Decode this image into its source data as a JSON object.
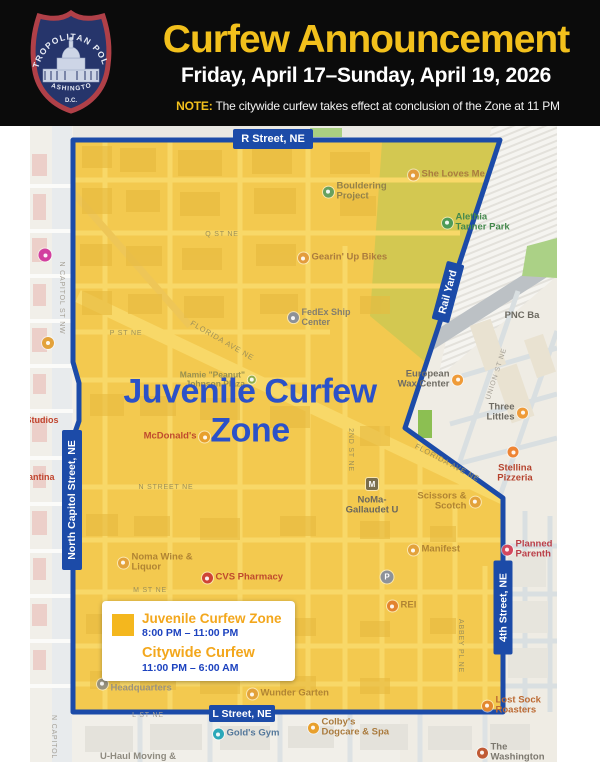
{
  "header": {
    "title": "Curfew Announcement",
    "date_range": "Friday, April 17–Sunday, April 19, 2026",
    "note_label": "NOTE:",
    "note_text": "The citywide curfew takes effect at conclusion of the Zone at 11 PM",
    "badge": {
      "top": "METROPOLITAN POLICE",
      "middle": "WASHINGTON",
      "bottom": "D.C."
    }
  },
  "map": {
    "zone_title": "Juvenile Curfew\nZone",
    "signs": [
      "R Street, NE",
      "North Capitol Street, NE",
      "Rail Yard",
      "4th Street, NE",
      "L Street, NE"
    ],
    "pois": [
      {
        "name": "q-st",
        "x": 222,
        "y": 235,
        "label": "Q ST NE",
        "color": "#9c8f58",
        "size": 7,
        "ls": 0.8,
        "align": "center"
      },
      {
        "name": "p-st",
        "x": 126,
        "y": 334,
        "label": "P ST NE",
        "color": "#9c8f58",
        "size": 7,
        "ls": 0.8,
        "align": "center"
      },
      {
        "name": "florida-ave-w",
        "x": 222,
        "y": 341,
        "label": "FLORIDA AVE NE",
        "color": "#9c8f58",
        "size": 7.5,
        "ls": 0.8,
        "align": "center",
        "rotate": 30
      },
      {
        "name": "n-street",
        "x": 166,
        "y": 488,
        "label": "N STREET NE",
        "color": "#9c8f58",
        "size": 7,
        "ls": 0.8,
        "align": "center"
      },
      {
        "name": "2nd-st",
        "x": 350,
        "y": 450,
        "label": "2ND ST NE",
        "color": "#9c8f58",
        "size": 7,
        "ls": 0.8,
        "align": "center",
        "rotate": 90
      },
      {
        "name": "m-st",
        "x": 150,
        "y": 591,
        "label": "M ST NE",
        "color": "#9c8f58",
        "size": 7,
        "ls": 0.8,
        "align": "center"
      },
      {
        "name": "union-st",
        "x": 497,
        "y": 374,
        "label": "UNION ST NE",
        "color": "#a5a096",
        "size": 7,
        "ls": 0.8,
        "align": "center",
        "rotate": -72
      },
      {
        "name": "abbey-pl",
        "x": 460,
        "y": 646,
        "label": "ABBEY PL NE",
        "color": "#9c8f58",
        "size": 7,
        "ls": 0.8,
        "align": "center",
        "rotate": 90
      },
      {
        "name": "n-capitol-st-nw",
        "x": 61,
        "y": 298,
        "label": "N CAPITOL ST NW",
        "color": "#a5a096",
        "size": 7,
        "ls": 0.8,
        "align": "center",
        "rotate": 90
      },
      {
        "name": "n-capitol",
        "x": 53,
        "y": 737,
        "label": "N CAPITOL",
        "color": "#a5a096",
        "size": 7,
        "ls": 0.8,
        "align": "center",
        "rotate": 90
      },
      {
        "name": "florida-ave-e",
        "x": 447,
        "y": 463,
        "label": "FLORIDA AVE NE",
        "color": "#9c8f58",
        "size": 7.5,
        "ls": 0.8,
        "align": "center",
        "rotate": 28
      },
      {
        "name": "l-st",
        "x": 148,
        "y": 716,
        "label": "L ST NE",
        "color": "#a5a096",
        "size": 7,
        "ls": 0.8,
        "align": "center"
      },
      {
        "name": "she-loves-me",
        "x": 413,
        "y": 175,
        "label": "She Loves Me",
        "color": "#aa7b3e",
        "size": 9.5,
        "bold": true,
        "icon": "#e39c3d",
        "align": "left"
      },
      {
        "name": "bouldering-project",
        "x": 328,
        "y": 192,
        "label": "Bouldering\nProject",
        "color": "#93824a",
        "size": 9.5,
        "bold": true,
        "icon": "#67a15e",
        "align": "left"
      },
      {
        "name": "alethia-tanner-park",
        "x": 447,
        "y": 223,
        "label": "Alethia\nTanner Park",
        "color": "#45894d",
        "size": 9.5,
        "bold": true,
        "icon": "#4d9b57",
        "align": "left"
      },
      {
        "name": "gearin-up-bikes",
        "x": 303,
        "y": 258,
        "label": "Gearin' Up Bikes",
        "color": "#aa7b3e",
        "size": 9.5,
        "bold": true,
        "icon": "#e39c3d",
        "align": "left"
      },
      {
        "name": "fedex-ship-center",
        "x": 293,
        "y": 318,
        "label": "FedEx Ship\nCenter",
        "color": "#837e6e",
        "size": 9,
        "bold": true,
        "icon": "#8d9197",
        "align": "left"
      },
      {
        "name": "mamie-johnson-plaza",
        "x": 252,
        "y": 380,
        "label": "Mamie \"Peanut\"\nJohnson Plaza",
        "color": "#98904f",
        "size": 8.5,
        "bold": true,
        "icon": "#8fae4a",
        "iconSize": 8,
        "align": "right"
      },
      {
        "name": "european-wax-center",
        "x": 458,
        "y": 380,
        "label": "European\nWax Center",
        "color": "#6f6c64",
        "size": 9.5,
        "bold": true,
        "icon": "#ef9b38",
        "align": "right"
      },
      {
        "name": "pnc-bank",
        "x": 522,
        "y": 316,
        "label": "PNC Ba",
        "color": "#6c6960",
        "size": 9.5,
        "bold": true,
        "align": "left"
      },
      {
        "name": "three-littles",
        "x": 523,
        "y": 413,
        "label": "Three Littles",
        "color": "#6f6c64",
        "size": 9.5,
        "bold": true,
        "icon": "#ef9b38",
        "align": "right"
      },
      {
        "name": "stellina-icon",
        "x": 513,
        "y": 452,
        "icon": "#ee8434",
        "align": "center"
      },
      {
        "name": "stellina-pizzeria",
        "x": 515,
        "y": 474,
        "label": "Stellina\nPizzeria",
        "color": "#b5432e",
        "size": 9.5,
        "bold": true,
        "align": "center"
      },
      {
        "name": "mcdonalds",
        "x": 205,
        "y": 437,
        "label": "McDonald's",
        "color": "#bf4a2e",
        "size": 9.5,
        "bold": true,
        "icon": "#e8a02c",
        "align": "right"
      },
      {
        "name": "noma-metro",
        "x": 372,
        "y": 484,
        "icon": "#7a6e4d",
        "glyph": "M",
        "shape": "square",
        "iconSize": 12,
        "align": "center"
      },
      {
        "name": "noma-gallaudet",
        "x": 372,
        "y": 506,
        "label": "NoMa-\nGallaudet U",
        "color": "#6b675d",
        "size": 9.5,
        "bold": true,
        "align": "center"
      },
      {
        "name": "scissors-scotch",
        "x": 475,
        "y": 502,
        "label": "Scissors &\nScotch",
        "color": "#b08433",
        "size": 9.5,
        "bold": true,
        "icon": "#e3a23b",
        "align": "right"
      },
      {
        "name": "manifest",
        "x": 413,
        "y": 550,
        "label": "Manifest",
        "color": "#b08433",
        "size": 9.5,
        "bold": true,
        "icon": "#e3a23b",
        "align": "left"
      },
      {
        "name": "planned-parenthood",
        "x": 507,
        "y": 550,
        "label": "Planned\nParenth",
        "color": "#bb3f49",
        "size": 9.5,
        "bold": true,
        "icon": "#d5485e",
        "align": "left"
      },
      {
        "name": "parking",
        "x": 387,
        "y": 577,
        "icon": "#8d9299",
        "glyph": "P",
        "iconSize": 13,
        "align": "center"
      },
      {
        "name": "rei",
        "x": 392,
        "y": 606,
        "label": "REI",
        "color": "#b08433",
        "size": 9.5,
        "bold": true,
        "icon": "#e3832f",
        "align": "left"
      },
      {
        "name": "noma-wine-liquor",
        "x": 123,
        "y": 563,
        "label": "Noma Wine &\nLiquor",
        "color": "#b08433",
        "size": 9.5,
        "bold": true,
        "icon": "#e3a23b",
        "align": "left"
      },
      {
        "name": "cvs-pharmacy",
        "x": 207,
        "y": 578,
        "label": "CVS Pharmacy",
        "color": "#bf4a2e",
        "size": 9.5,
        "bold": true,
        "icon": "#cf4436",
        "align": "left"
      },
      {
        "name": "public-radio-hq",
        "x": 102,
        "y": 684,
        "label": "Public Radio -\nHeadquarters",
        "color": "#9b9480",
        "size": 9.5,
        "bold": true,
        "icon": "#98937f",
        "align": "left"
      },
      {
        "name": "wunder-garten",
        "x": 252,
        "y": 694,
        "label": "Wunder Garten",
        "color": "#b08433",
        "size": 9.5,
        "bold": true,
        "icon": "#e3a23b",
        "align": "left"
      },
      {
        "name": "lost-sock-roasters",
        "x": 487,
        "y": 706,
        "label": "Lost Sock\nRoasters",
        "color": "#bc6a33",
        "size": 9.5,
        "bold": true,
        "icon": "#e3882f",
        "align": "left"
      },
      {
        "name": "golds-gym",
        "x": 218,
        "y": 734,
        "label": "Gold's Gym",
        "color": "#54789b",
        "size": 9.5,
        "bold": true,
        "icon": "#2ba8b9",
        "align": "left"
      },
      {
        "name": "colbys-dogcare",
        "x": 313,
        "y": 728,
        "label": "Colby's\nDogcare & Spa",
        "color": "#aa7b3e",
        "size": 9.5,
        "bold": true,
        "icon": "#e8a02c",
        "align": "left"
      },
      {
        "name": "the-washington",
        "x": 482,
        "y": 753,
        "label": "The Washington",
        "color": "#7c786f",
        "size": 9.5,
        "bold": true,
        "icon": "#c05a35",
        "align": "left"
      },
      {
        "name": "u-haul",
        "x": 138,
        "y": 757,
        "label": "U-Haul Moving &",
        "color": "#8f8b80",
        "size": 9.5,
        "bold": true,
        "align": "center"
      },
      {
        "name": "studios",
        "x": 42,
        "y": 421,
        "label": "Studios",
        "color": "#c0452f",
        "size": 9,
        "bold": true,
        "align": "center"
      },
      {
        "name": "cantina",
        "x": 38,
        "y": 478,
        "label": "Cantina",
        "color": "#c0452f",
        "size": 9,
        "bold": true,
        "align": "center"
      },
      {
        "name": "metro-left-icon",
        "x": 45,
        "y": 255,
        "icon": "#d23f9f",
        "iconSize": 13,
        "align": "center"
      },
      {
        "name": "left-poi-icon",
        "x": 48,
        "y": 343,
        "icon": "#e3a23b",
        "iconSize": 12,
        "align": "center"
      }
    ]
  },
  "legend": {
    "zone_label": "Juvenile Curfew Zone",
    "zone_hours": "8:00 PM – 11:00 PM",
    "city_label": "Citywide Curfew",
    "city_hours": "11:00 PM – 6:00 AM"
  },
  "colors": {
    "header_bg": "#0b0b0b",
    "accent_yellow": "#f2c01c",
    "zone_fill": "#f3c94f",
    "border_blue": "#1c4ba8",
    "zone_title_blue": "#2b51c8",
    "legend_orange": "#f3a71c",
    "legend_time_blue": "#1c42bf"
  }
}
